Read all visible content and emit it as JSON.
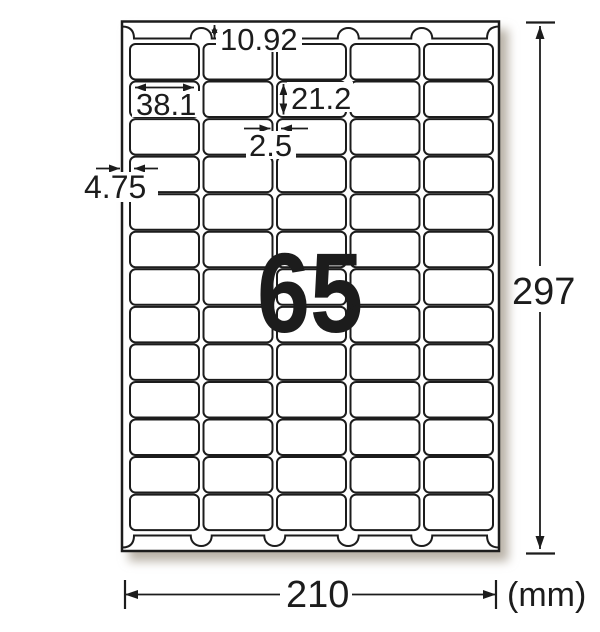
{
  "diagram": {
    "watermark_count": "65",
    "sheet": {
      "rows": 13,
      "columns": 5
    },
    "dimensions": {
      "top_margin_mm": "10.92",
      "label_width_mm": "38.1",
      "label_height_mm": "21.2",
      "column_gap_mm": "2.5",
      "side_margin_mm": "4.75",
      "sheet_height_mm": "297",
      "sheet_width_mm": "210",
      "unit_label": "(mm)"
    },
    "colors": {
      "line": "#1c1c1c",
      "watermark_pink": "#f5abd0",
      "paper": "#ffffff"
    }
  }
}
